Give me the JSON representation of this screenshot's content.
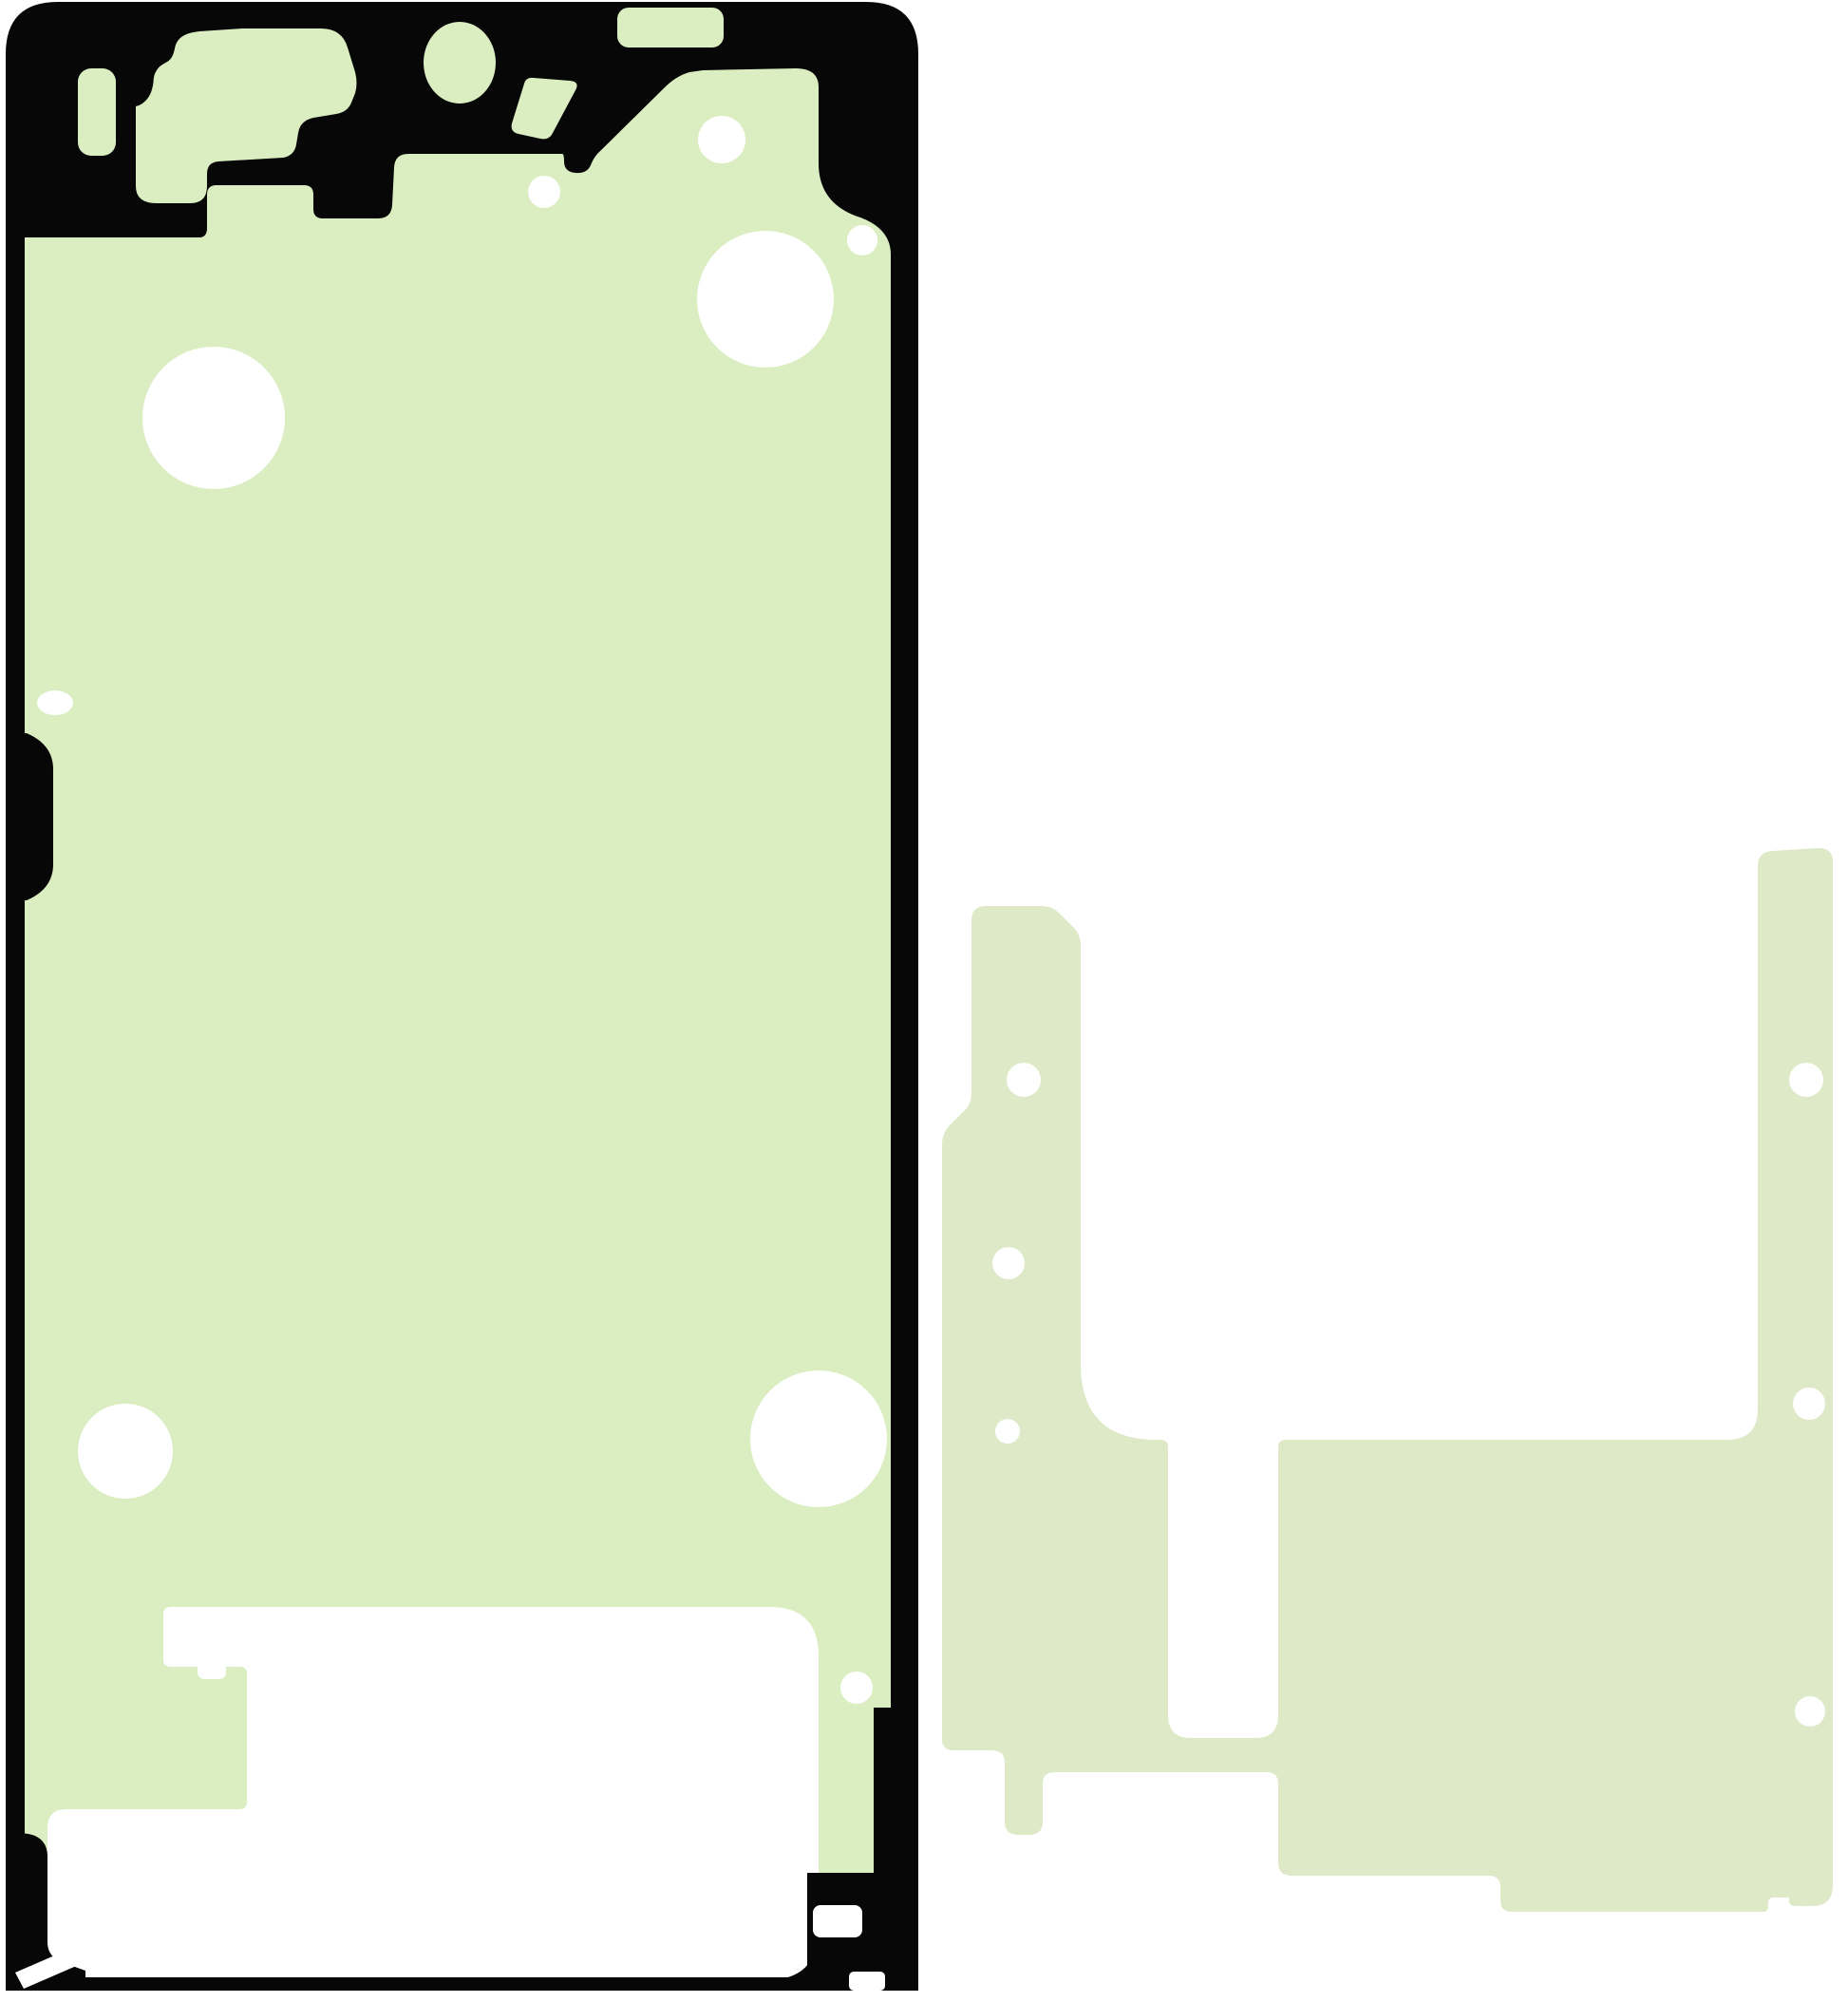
{
  "scene": {
    "background_color": "#ffffff",
    "description": "Product photo of two die-cut smartphone adhesive sheets (display frame gasket with black border and plain rework sheet) on a white background"
  },
  "left_piece": {
    "name": "Display frame adhesive with black gasket outline",
    "fill": "#dbeec2",
    "outline_color": "#070707",
    "cutout_color": "#ffffff",
    "camera_holes": 1,
    "round_holes": 9,
    "screen_window_cutouts": 1
  },
  "right_piece": {
    "name": "Plain die-cut rework adhesive sheet",
    "fill": "#dee9c7",
    "round_holes": 6
  }
}
